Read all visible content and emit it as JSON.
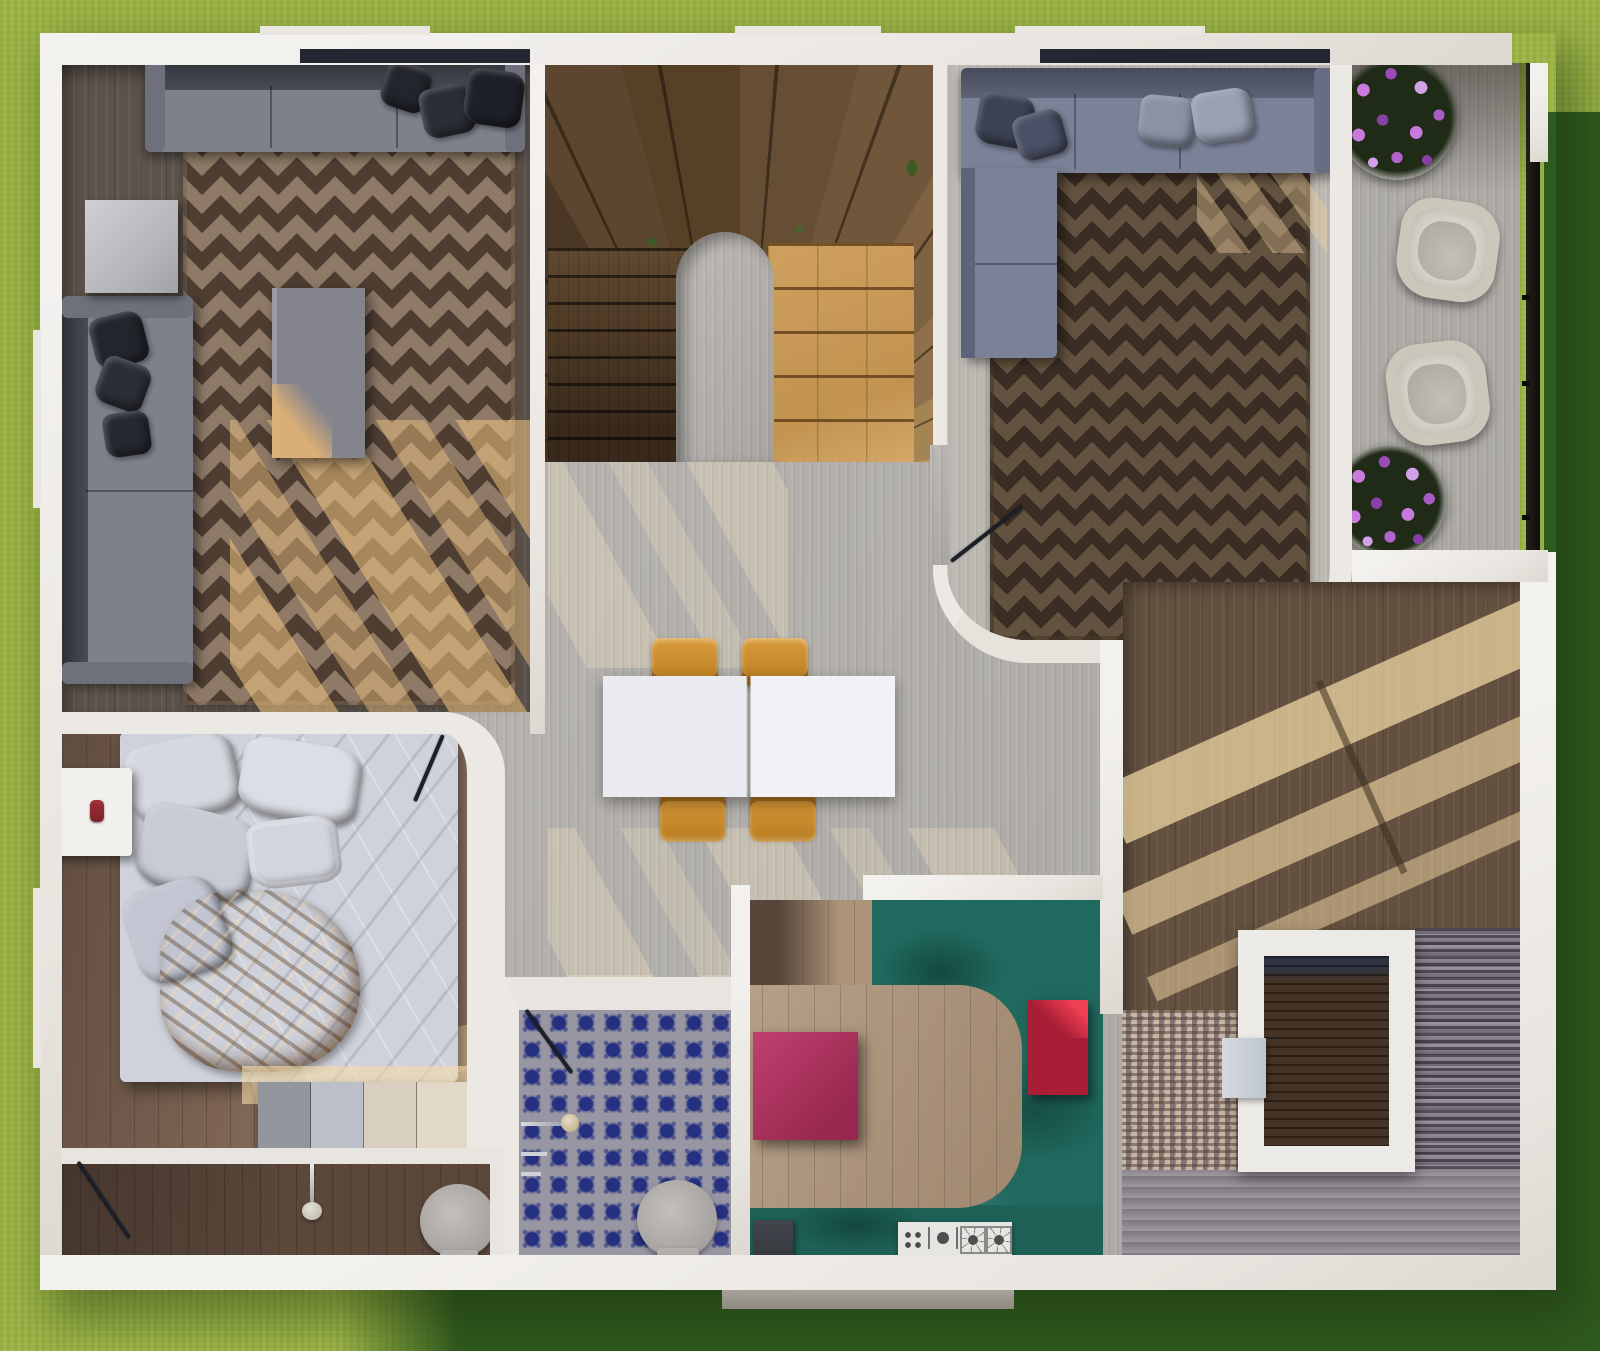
{
  "scene": {
    "type": "3d-floorplan-top-down-render",
    "description": "Top-down 3D render of a single-storey house floor plan surrounded by lawn",
    "rooms": [
      {
        "id": "living-room",
        "label": "Living room",
        "floor": "dark wood",
        "furniture": [
          "three-seat sofa",
          "two-seat sofa",
          "side table",
          "coffee table",
          "diamond-pattern rug"
        ]
      },
      {
        "id": "stair-hall",
        "label": "U-shaped wooden staircase",
        "furniture": [
          "dark flight",
          "fan winders",
          "oak flight"
        ]
      },
      {
        "id": "family-room",
        "label": "Family room",
        "floor": "travertine",
        "furniture": [
          "sectional sofa",
          "diamond-pattern rug",
          "open door"
        ]
      },
      {
        "id": "deck",
        "label": "Timber deck",
        "furniture": [
          "wicker armchair",
          "wicker armchair",
          "purple flower planter",
          "purple flower planter",
          "railing"
        ]
      },
      {
        "id": "hall-dining",
        "label": "Hall / dining area",
        "floor": "travertine",
        "furniture": [
          "white dining table",
          "four orange chairs"
        ]
      },
      {
        "id": "bedroom",
        "label": "Bedroom",
        "floor": "walnut wood",
        "furniture": [
          "double bed",
          "nightstand",
          "four-panel dresser",
          "open door"
        ]
      },
      {
        "id": "bathroom-blue",
        "label": "Blue-tile bathroom",
        "furniture": [
          "toilet",
          "wall shower fixtures",
          "open door"
        ]
      },
      {
        "id": "bathroom-ensuite",
        "label": "En-suite bathroom",
        "furniture": [
          "toilet",
          "washbasin tap",
          "open door"
        ]
      },
      {
        "id": "kitchen",
        "label": "Kitchen",
        "furniture": [
          "U-shaped teal counter",
          "magenta island",
          "crimson stool",
          "gas cooktop",
          "dark appliance"
        ]
      },
      {
        "id": "stairwell",
        "label": "Granite staircase with stairwell void",
        "furniture": [
          "light granite flight",
          "dark granite flight",
          "wide landing steps",
          "void frame"
        ]
      }
    ],
    "palette": {
      "grass-light": "#9cb545",
      "grass-dark": "#2f5a1e",
      "wall": "#e9e5e0",
      "travertine": "#b5b2ad",
      "wood-living": "#5d534c",
      "wood-bedroom": "#7b6252",
      "rug-living-base": "#8f7a68",
      "rug-living-dark": "#4e3e32",
      "rug-family-base": "#63523f",
      "rug-family-dark": "#3a2d23",
      "sofa-gray": "#7e818c",
      "sofa-slate": "#7b8298",
      "deck-wood": "#8e6f50",
      "teal-counter": "#20695e",
      "magenta-island": "#a72d5e",
      "crimson-stool": "#b5203c",
      "oak-light": "#c79a5c",
      "stair-dark": "#54402c",
      "tile-blue": "#2a3694",
      "granite-light": "#c8b6a4",
      "granite-dark": "#8f8894",
      "sunlight": "#f2d8a4",
      "chair-orange": "#c98a2e"
    }
  }
}
